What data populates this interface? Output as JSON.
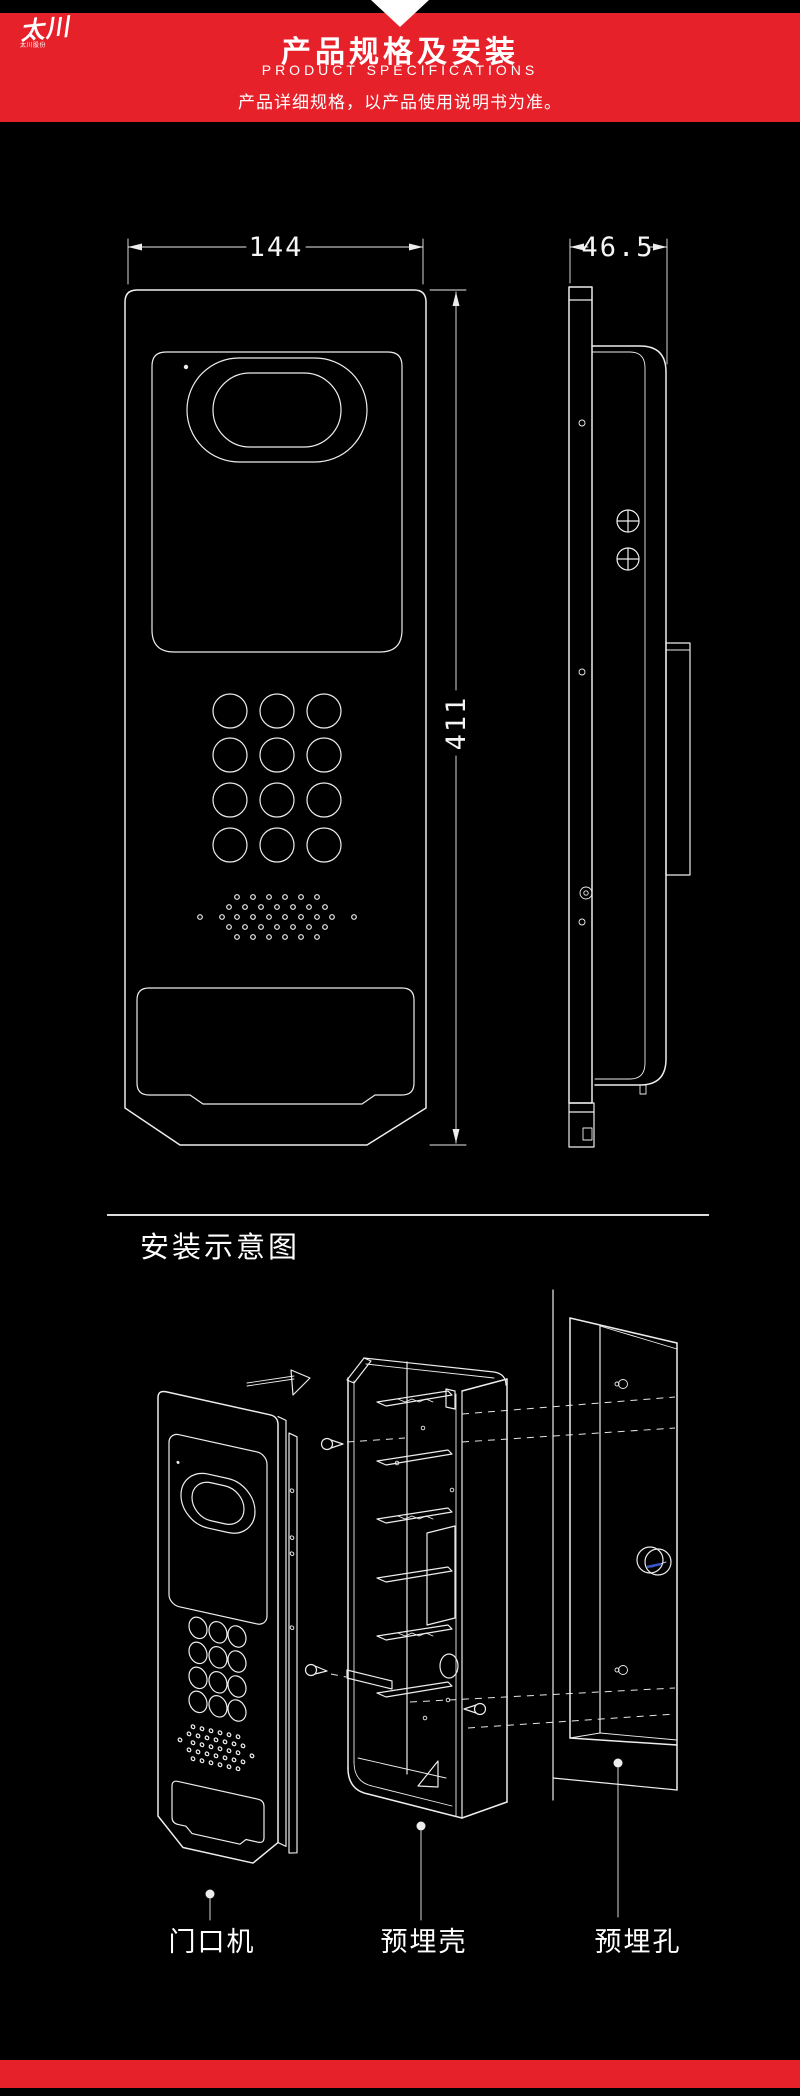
{
  "header": {
    "logo": {
      "mark": "太川",
      "sub": "太川股份"
    },
    "title": "产品规格及安装",
    "subtitle": "PRODUCT SPECIFICATIONS",
    "tagline": "产品详细规格，以产品使用说明书为准。"
  },
  "drawing": {
    "front_view": {
      "width_dim": "144",
      "height_dim": "411"
    },
    "side_view": {
      "depth_dim": "46.5"
    }
  },
  "installation": {
    "section_title": "安装示意图",
    "labels": {
      "door_station": "门口机",
      "embedded_shell": "预埋壳",
      "embedded_hole": "预埋孔"
    }
  },
  "colors": {
    "accent_red": "#e6212a",
    "line_white": "#ededed",
    "hole_blue": "#3a57c9",
    "background": "#000000"
  }
}
